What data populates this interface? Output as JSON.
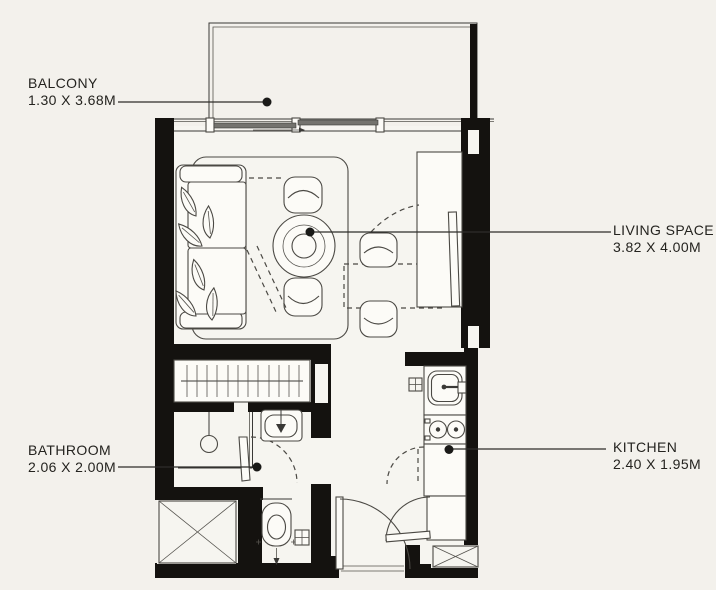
{
  "canvas": {
    "width": 716,
    "height": 590,
    "background": "#f3f1ec"
  },
  "plan": {
    "type": "apartment-floor-plan",
    "colors": {
      "walls": "#14120f",
      "lines": "#4b4944",
      "leaders": "#2e2d2a",
      "text": "#24231f",
      "furniture_fill": "#fcfbf7",
      "floor_fill": "#f6f5f0",
      "glazing_panel": "#74736e"
    },
    "labels": [
      {
        "id": "balcony",
        "name": "BALCONY",
        "dimensions": "1.30 X 3.68M",
        "side": "left"
      },
      {
        "id": "living-space",
        "name": "LIVING SPACE",
        "dimensions": "3.82 X 4.00M",
        "side": "right"
      },
      {
        "id": "bathroom",
        "name": "BATHROOM",
        "dimensions": "2.06 X 2.00M",
        "side": "left"
      },
      {
        "id": "kitchen",
        "name": "KITCHEN",
        "dimensions": "2.40 X 1.95M",
        "side": "right"
      }
    ],
    "fixtures": [
      "sofa",
      "throw-pillows",
      "rug",
      "coffee-table",
      "lounge-chair-top",
      "lounge-chair-bottom",
      "dining-table",
      "dining-chair-top",
      "dining-chair-bottom",
      "tv-unit",
      "tv",
      "sliding-balcony-window",
      "wardrobe",
      "shower",
      "washbasin",
      "toilet",
      "floor-drain",
      "kitchen-sink",
      "hob",
      "kitchen-cabinet",
      "kitchen-lower-cabinet",
      "entry-door",
      "closet-door",
      "bathroom-door",
      "shaft-crossed",
      "shaft-flue"
    ]
  }
}
